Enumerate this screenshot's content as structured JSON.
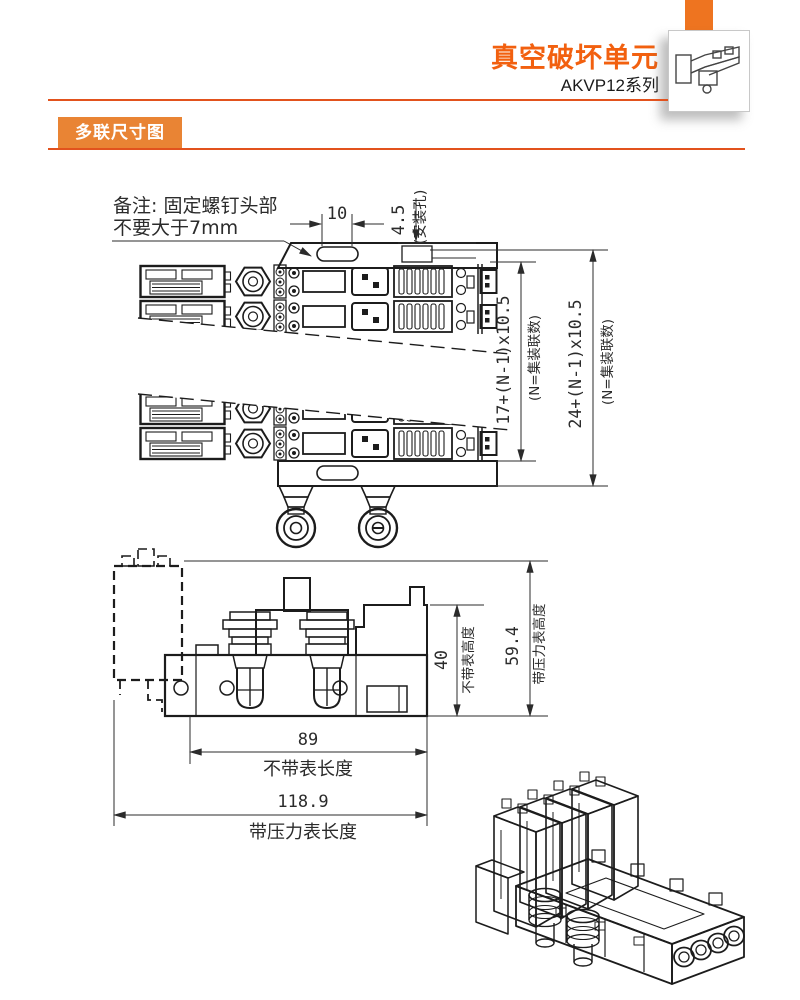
{
  "colors": {
    "accent_tab": "#EE7420",
    "title_orange": "#F2600F",
    "badge_orange": "#E98434",
    "rule_orange": "#E2521D",
    "line_art": "#1c1c1c"
  },
  "header": {
    "title": "真空破坏单元",
    "series": "AKVP12系列",
    "thumbnail_icon": "product-isometric-sketch"
  },
  "section": {
    "label": "多联尺寸图"
  },
  "top_drawing": {
    "note_line1": "备注: 固定螺钉头部",
    "note_line2": "不要大于7mm",
    "dim_slot": "10",
    "dim_hole": "4.5",
    "dim_hole_label": "(安装孔)",
    "dim_height_body": "17+(N-1)x10.5",
    "dim_height_body_note": "(N=集装联数)",
    "dim_height_total": "24+(N-1)x10.5",
    "dim_height_total_note": "(N=集装联数)"
  },
  "side_drawing": {
    "dim_height_no_gauge": "40",
    "label_height_no_gauge": "不带表高度",
    "dim_height_with_gauge": "59.4",
    "label_height_with_gauge": "带压力表高度",
    "dim_length_no_gauge": "89",
    "label_length_no_gauge": "不带表长度",
    "dim_length_with_gauge": "118.9",
    "label_length_with_gauge": "带压力表长度"
  }
}
